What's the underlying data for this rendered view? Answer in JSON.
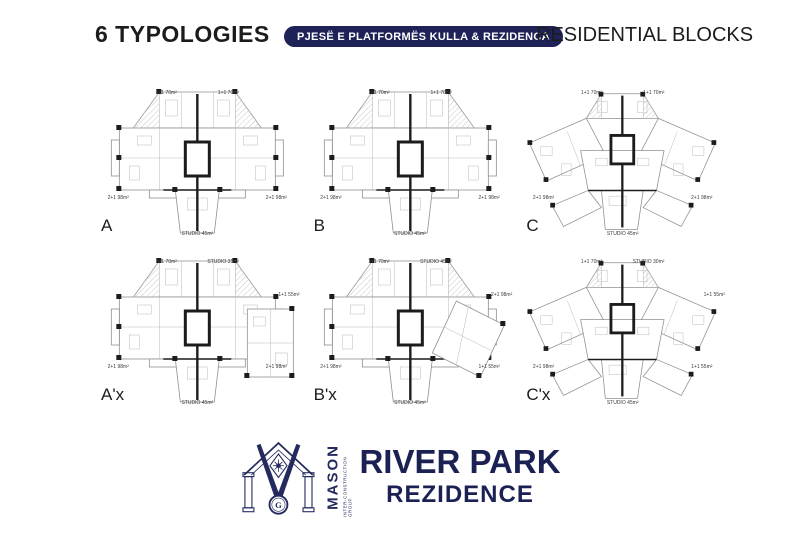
{
  "header": {
    "left_title": "6 TYPOLOGIES",
    "badge": "PJESË E PLATFORMËS KULLA & REZIDENCA",
    "right_title": "RESIDENTIAL BLOCKS"
  },
  "colors": {
    "navy": "#1e2257",
    "ink": "#1c1c1e"
  },
  "plans": [
    {
      "letter": "A",
      "labels": {
        "top_left": "1+1 70m²",
        "top_right": "1+1 70m²",
        "bottom_left": "2+1 98m²",
        "bottom_right": "2+1 98m²",
        "bottom_center": "STUDIO 45m²"
      }
    },
    {
      "letter": "B",
      "labels": {
        "top_left": "1+1 70m²",
        "top_right": "1+1 70m²",
        "bottom_left": "2+1 98m²",
        "bottom_right": "2+1 98m²",
        "bottom_center": "STUDIO 45m²"
      }
    },
    {
      "letter": "C",
      "labels": {
        "top_left": "1+1 70m²",
        "top_right": "1+1 70m²",
        "bottom_left": "2+1 98m²",
        "bottom_right": "2+1 98m²",
        "bottom_center": "STUDIO 45m²"
      }
    },
    {
      "letter": "A'x",
      "labels": {
        "top_left": "1+1 70m²",
        "top_right": "STUDIO 35m²",
        "right": "1+1 55m²",
        "bottom_left": "2+1 98m²",
        "bottom_right": "2+1 98m²",
        "bottom_center": "STUDIO 45m²"
      }
    },
    {
      "letter": "B'x",
      "labels": {
        "top_left": "1+1 70m²",
        "top_right": "STUDIO 45m²",
        "right": "2+1 98m²",
        "bottom_left": "2+1 98m²",
        "bottom_right": "1+1 55m²",
        "bottom_center": "STUDIO 45m²"
      }
    },
    {
      "letter": "C'x",
      "labels": {
        "top_left": "1+1 70m²",
        "top_right": "STUDIO 30m²",
        "right": "1+1 55m²",
        "bottom_left": "2+1 98m²",
        "bottom_right": "1+1 55m²",
        "bottom_center": "STUDIO 45m²"
      }
    }
  ],
  "logo": {
    "brand": "MASON",
    "brand_sub": "INTER-CONSTRUCTION GROUP",
    "emblem_letter": "G",
    "project_title": "RIVER PARK",
    "project_subtitle": "REZIDENCE"
  }
}
